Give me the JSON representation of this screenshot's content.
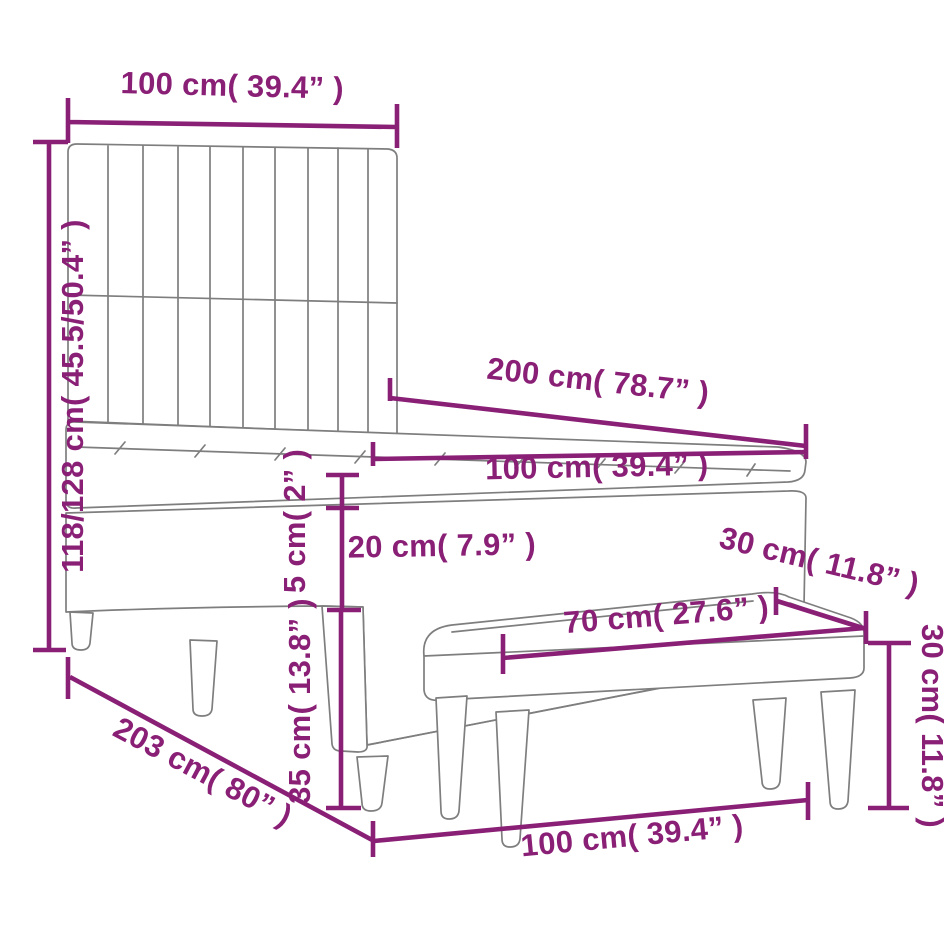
{
  "figure": {
    "type": "furniture-dimension-diagram",
    "subject": "box spring bed with vertical-channel headboard, mattress topper and upholstered bench",
    "accent_color": "#8a1f76",
    "outline_color": "#7e7e7e",
    "dimensions": {
      "headboard_width": "100 cm( 39.4” )",
      "headboard_height": "118/128 cm( 45.5/50.4” )",
      "bed_length": "200 cm( 78.7” )",
      "bed_width": "100 cm( 39.4” )",
      "topper_thickness": "5 cm( 2” )",
      "mattress_thickness": "20 cm( 7.9” )",
      "base_height": "35 cm( 13.8” )",
      "total_length": "203 cm( 80” )",
      "bottom_width": "100 cm( 39.4” )",
      "bench_depth": "30 cm( 11.8” )",
      "bench_length": "70 cm( 27.6” )",
      "bench_height": "30 cm( 11.8” )"
    }
  }
}
